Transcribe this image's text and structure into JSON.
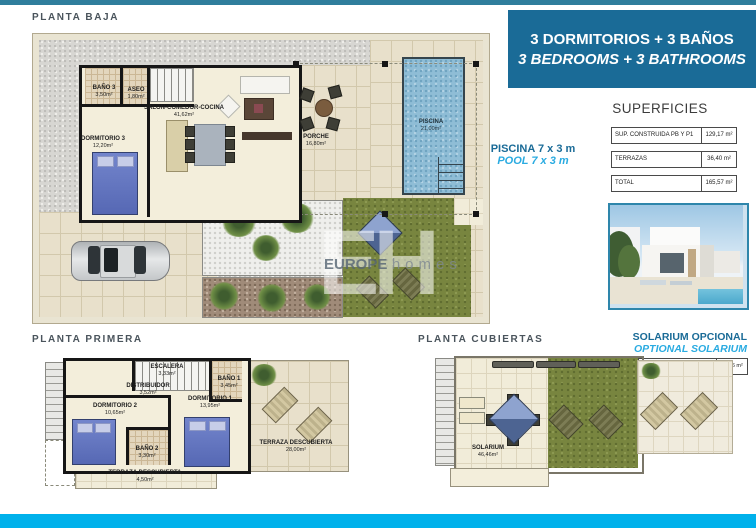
{
  "colors": {
    "top_bar": "#2f7e9c",
    "bottom_bar": "#00b1eb",
    "banner_bg": "#1a6b97",
    "accent_dark_blue": "#1a6b97",
    "accent_cyan": "#2aabe1"
  },
  "banner": {
    "line1": "3 DORMITORIOS + 3 BAÑOS",
    "line2": "3 BEDROOMS + 3 BATHROOMS"
  },
  "superficies": {
    "title": "SUPERFICIES",
    "rows": [
      {
        "label": "SUP. CONSTRUIDA PB Y P1",
        "value": "129,17 m²"
      },
      {
        "label": "TERRAZAS",
        "value": "36,40 m²"
      },
      {
        "label": "TOTAL",
        "value": "165,57 m²"
      }
    ]
  },
  "pool_note": {
    "es": "PISCINA 7 x 3 m",
    "en": "POOL 7 x 3 m"
  },
  "solarium_note": {
    "es": "SOLARIUM OPCIONAL",
    "en": "OPTIONAL SOLARIUM",
    "table_label": "SOLARIUM",
    "table_value": "46,46 m²"
  },
  "planta_baja": {
    "title": "PLANTA BAJA",
    "rooms": {
      "bano3": {
        "name": "BAÑO 3",
        "area": "3,50m²"
      },
      "aseo": {
        "name": "ASEO",
        "area": "1,80m²"
      },
      "salon": {
        "name": "SALON-COMEDOR-COCINA",
        "area": "41,62m²"
      },
      "dormitorio3": {
        "name": "DORMITORIO 3",
        "area": "12,20m²"
      },
      "porche": {
        "name": "PORCHE",
        "area": "16,80m²"
      },
      "piscina": {
        "name": "PISCINA",
        "area": "21,00m²"
      }
    }
  },
  "planta_primera": {
    "title": "PLANTA PRIMERA",
    "rooms": {
      "escalera": {
        "name": "ESCALERA",
        "area": "3,33m²"
      },
      "distribuidor": {
        "name": "DISTRIBUIDOR",
        "area": "3,52m²"
      },
      "bano1": {
        "name": "BAÑO 1",
        "area": "3,45m²"
      },
      "dormitorio1": {
        "name": "DORMITORIO 1",
        "area": "13,95m²"
      },
      "dormitorio2": {
        "name": "DORMITORIO 2",
        "area": "10,65m²"
      },
      "bano2": {
        "name": "BAÑO 2",
        "area": "3,30m²"
      },
      "terraza_front": {
        "name": "TERRAZA DESCUBIERTA",
        "area": "4,50m²"
      },
      "terraza_lateral": {
        "name": "TERRAZA DESCUBIERTA",
        "area": "28,00m²"
      }
    }
  },
  "planta_cubiertas": {
    "title": "PLANTA CUBIERTAS",
    "rooms": {
      "solarium": {
        "name": "SOLARIUM",
        "area": "46,46m²"
      }
    }
  },
  "watermark": {
    "initials": "EH",
    "brand1": "EUROPE",
    "brand2": "homes"
  }
}
